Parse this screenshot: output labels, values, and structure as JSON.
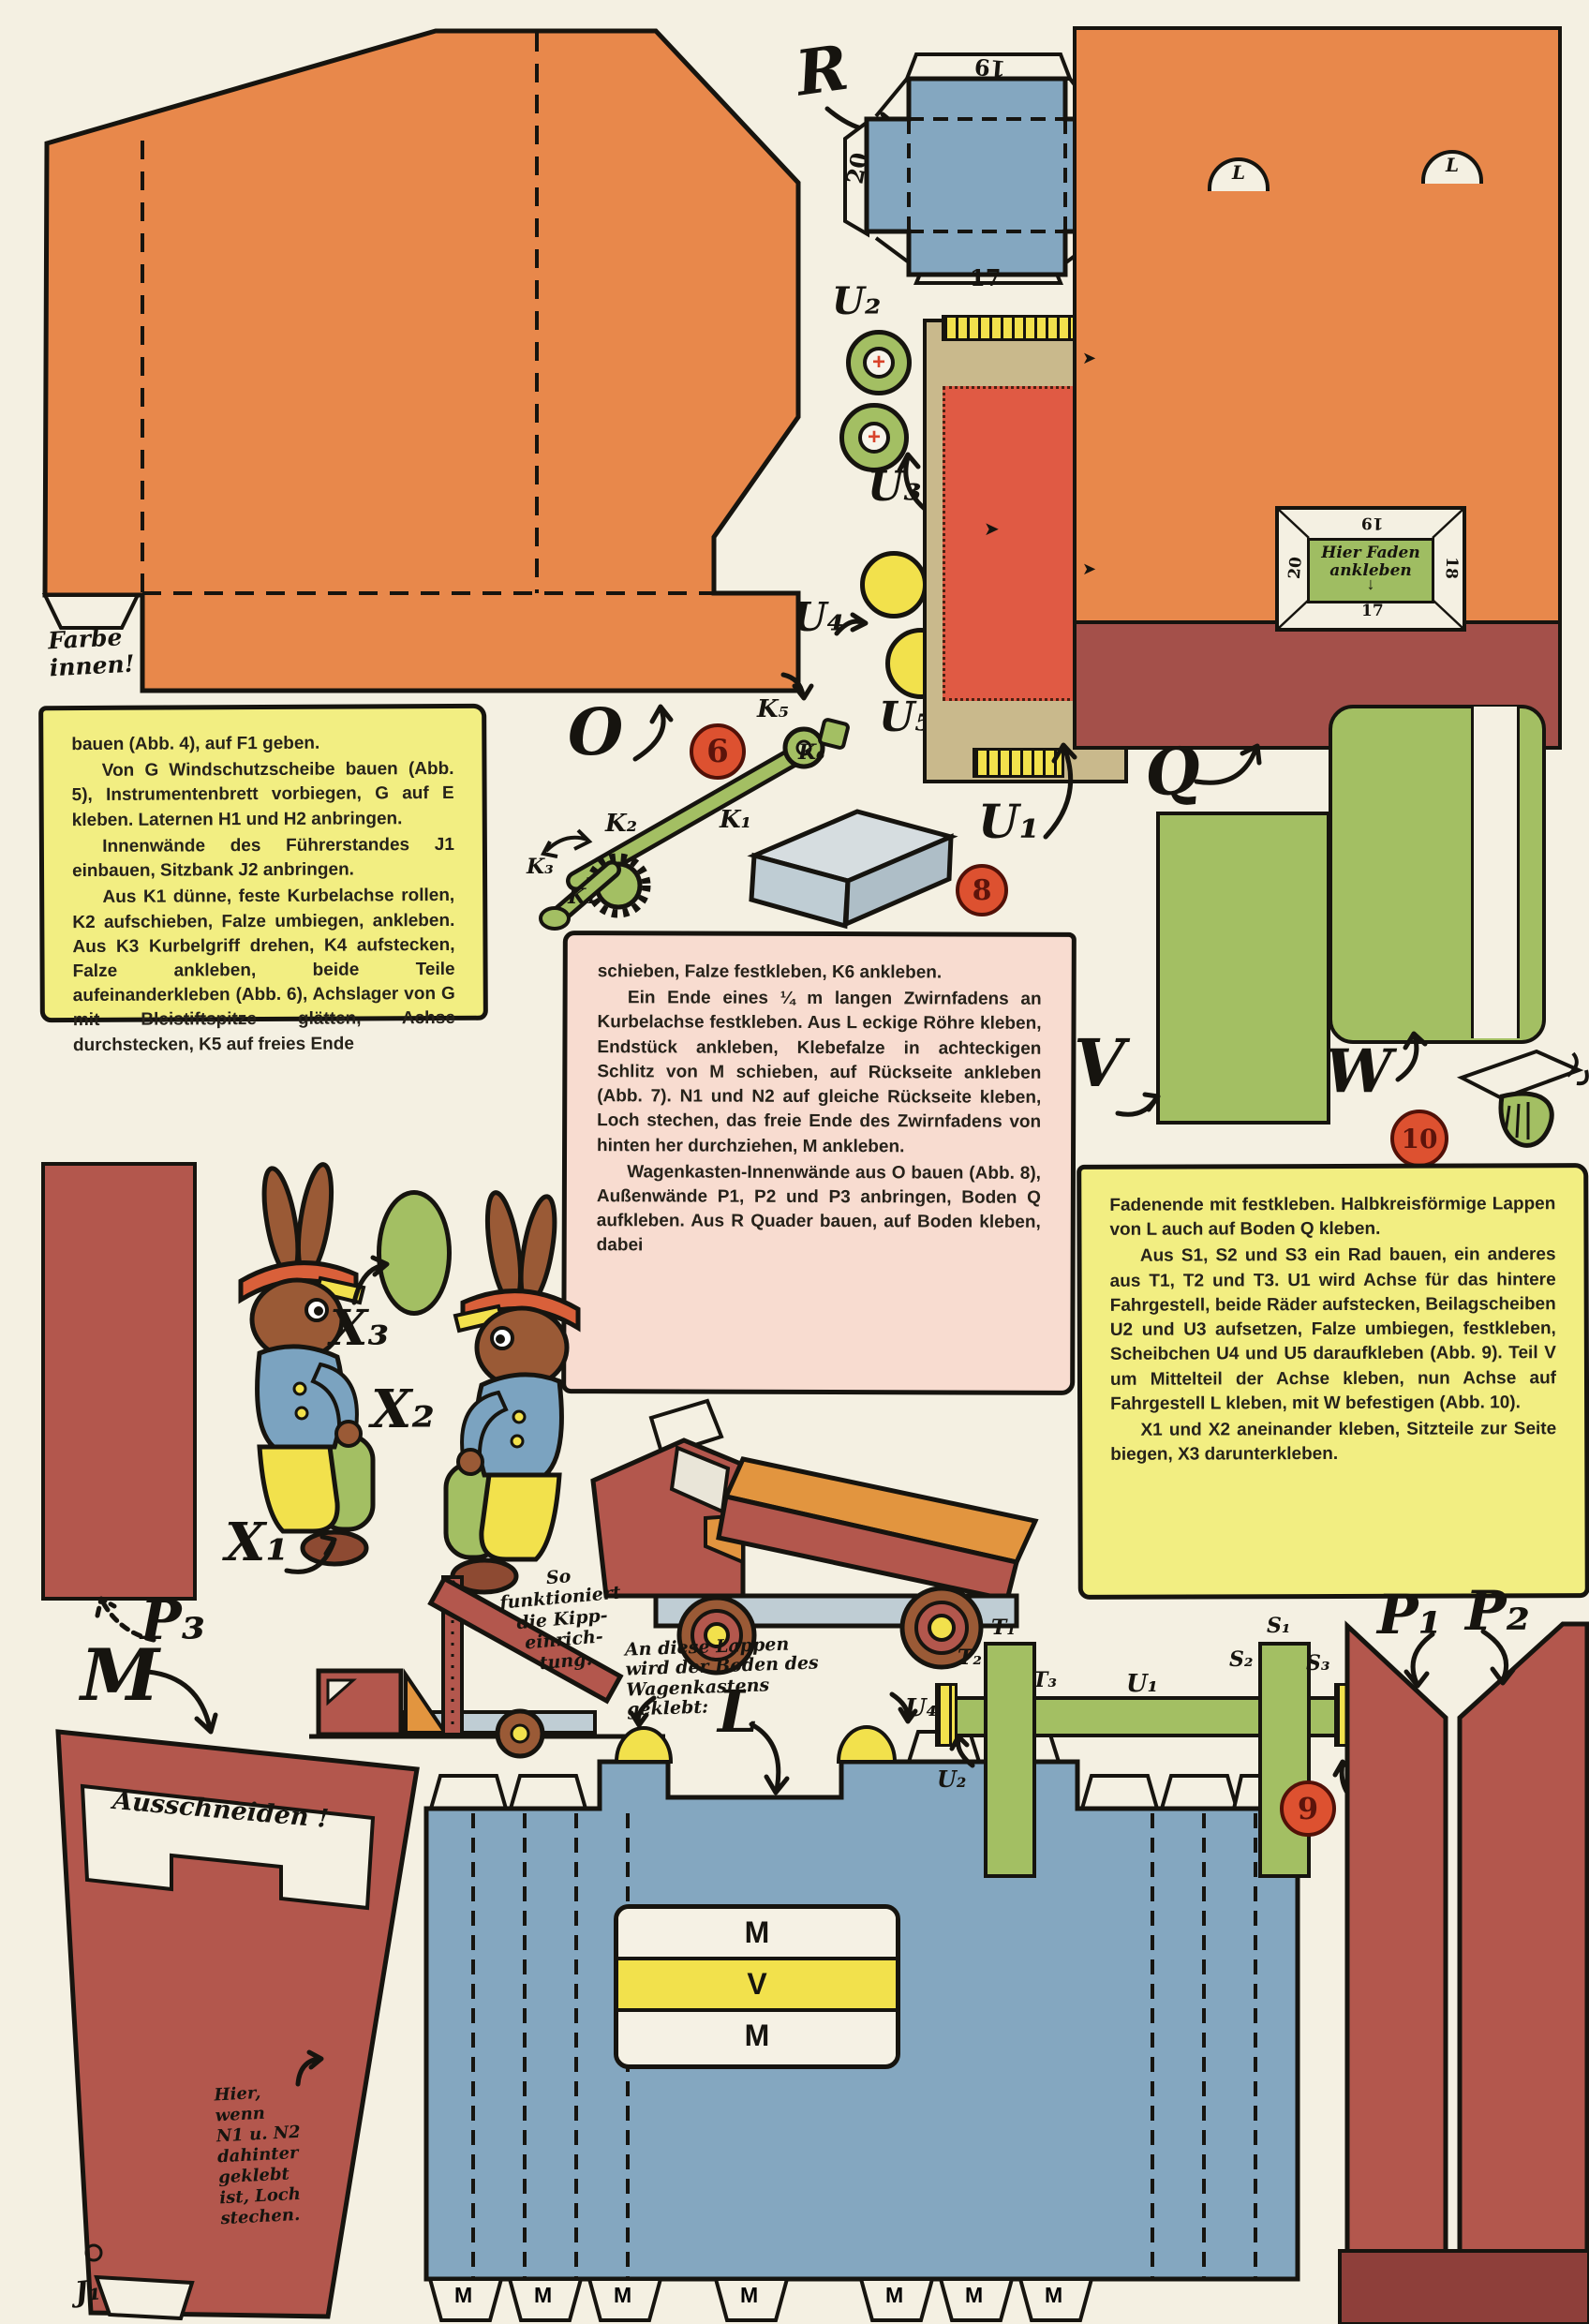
{
  "meta": {
    "type": "vintage paper-craft model sheet (Ausschneidebogen) for a toy dump truck"
  },
  "colors": {
    "paper": "#f4f0e2",
    "ink": "#16140f",
    "orange": "#e8884b",
    "blue": "#84a7c0",
    "green": "#a3bf63",
    "bright_yellow": "#f2e14c",
    "box_yellow": "#f2ee82",
    "box_pink": "#f8dcd0",
    "brick_red": "#b3574d",
    "maroon": "#a4504a",
    "tan": "#c9b98c",
    "salmon": "#e05a44",
    "badge_red": "#dd5130",
    "gray": "#bfcdd4"
  },
  "instructions": {
    "left": {
      "p1": "bauen (Abb. 4), auf F1 geben.",
      "p2": "Von G Windschutzscheibe bauen (Abb. 5), Instrumentenbrett vorbiegen, G auf E kleben. Laternen H1 und H2 anbringen.",
      "p3": "Innenwände des Führerstandes J1 einbauen, Sitzbank J2 anbringen.",
      "p4": "Aus K1 dünne, feste Kurbelachse rollen, K2 aufschieben, Falze umbiegen, ankleben. Aus K3 Kurbelgriff drehen, K4 aufstecken, Falze ankleben, beide Teile aufeinanderkleben (Abb. 6), Achslager von G mit Bleistiftspitze glätten, Achse durchstecken, K5 auf freies Ende"
    },
    "pink": {
      "p1": "schieben, Falze festkleben, K6 ankleben.",
      "p2": "Ein Ende eines ¼ m langen Zwirnfadens an Kurbelachse festkleben. Aus L eckige Röhre kleben, Endstück ankleben, Klebefalze in achteckigen Schlitz von M schieben, auf Rückseite ankleben (Abb. 7). N1 und N2 auf gleiche Rückseite kleben, Loch stechen, das freie Ende des Zwirnfadens von hinten her durchziehen, M ankleben.",
      "p3": "Wagenkasten-Innenwände aus O bauen (Abb. 8), Außenwände P1, P2 und P3 anbringen, Boden Q aufkleben. Aus R Quader bauen, auf Boden kleben, dabei"
    },
    "right": {
      "p1": "Fadenende mit festkleben. Halbkreisförmige Lappen von L auch auf Boden Q kleben.",
      "p2": "Aus S1, S2 und S3 ein Rad bauen, ein anderes aus T1, T2 und T3. U1 wird Achse für das hintere Fahrgestell, beide Räder aufstecken, Beilagscheiben U2 und U3 aufsetzen, Falze umbiegen, festkleben, Scheibchen U4 und U5 daraufkleben (Abb. 9). Teil V um Mittelteil der Achse kleben, nun Achse auf Fahrgestell L kleben, mit W befestigen (Abb. 10).",
      "p3": "X1 und X2 aneinander kleben, Sitzteile zur Seite biegen, X3 darunterkleben."
    }
  },
  "labels": {
    "r": "R",
    "o": "O",
    "q": "Q",
    "l": "L",
    "m": "M",
    "v": "V",
    "w": "W",
    "u1": "U₁",
    "u2": "U₂",
    "u3": "U₃",
    "u4": "U₄",
    "u5": "U₅",
    "k1": "K₁",
    "k2": "K₂",
    "k3": "K₃",
    "k4": "K₄",
    "k5": "K₅",
    "k6": "K₆",
    "p1": "P₁",
    "p2": "P₂",
    "p3": "P₃",
    "x1": "X₁",
    "x2": "X₂",
    "x3": "X₃",
    "s1": "S₁",
    "s2": "S₂",
    "s3": "S₃",
    "t1": "T₁",
    "t2": "T₂",
    "t3": "T₃",
    "j1": "J₁",
    "l_flap": "L"
  },
  "badges": {
    "b6": "6",
    "b8": "8",
    "b9": "9",
    "b10": "10"
  },
  "folds": {
    "top": "19",
    "left": "20",
    "right": "18",
    "bottom": "17"
  },
  "notes": {
    "farbe": "Farbe\ninnen!",
    "hier_faden": "Hier Faden\nankleben",
    "faden_arrow": "↓",
    "ausschneiden": "Ausschneiden !",
    "kipp": "So\nfunktioniert\ndie Kipp-\neinrich-\ntung.",
    "lappen": "An diese Lappen\nwird der Boden des\nWagenkastens\ngeklebt:",
    "loch": "Hier,\nwenn\nN1 u. N2\ndahinter\ngeklebt\nist, Loch\nstechen."
  },
  "window_bands": {
    "top": "M",
    "middle": "V",
    "bottom": "M"
  },
  "m_tabs": [
    "M",
    "M",
    "M",
    "M",
    "M",
    "M",
    "M"
  ]
}
